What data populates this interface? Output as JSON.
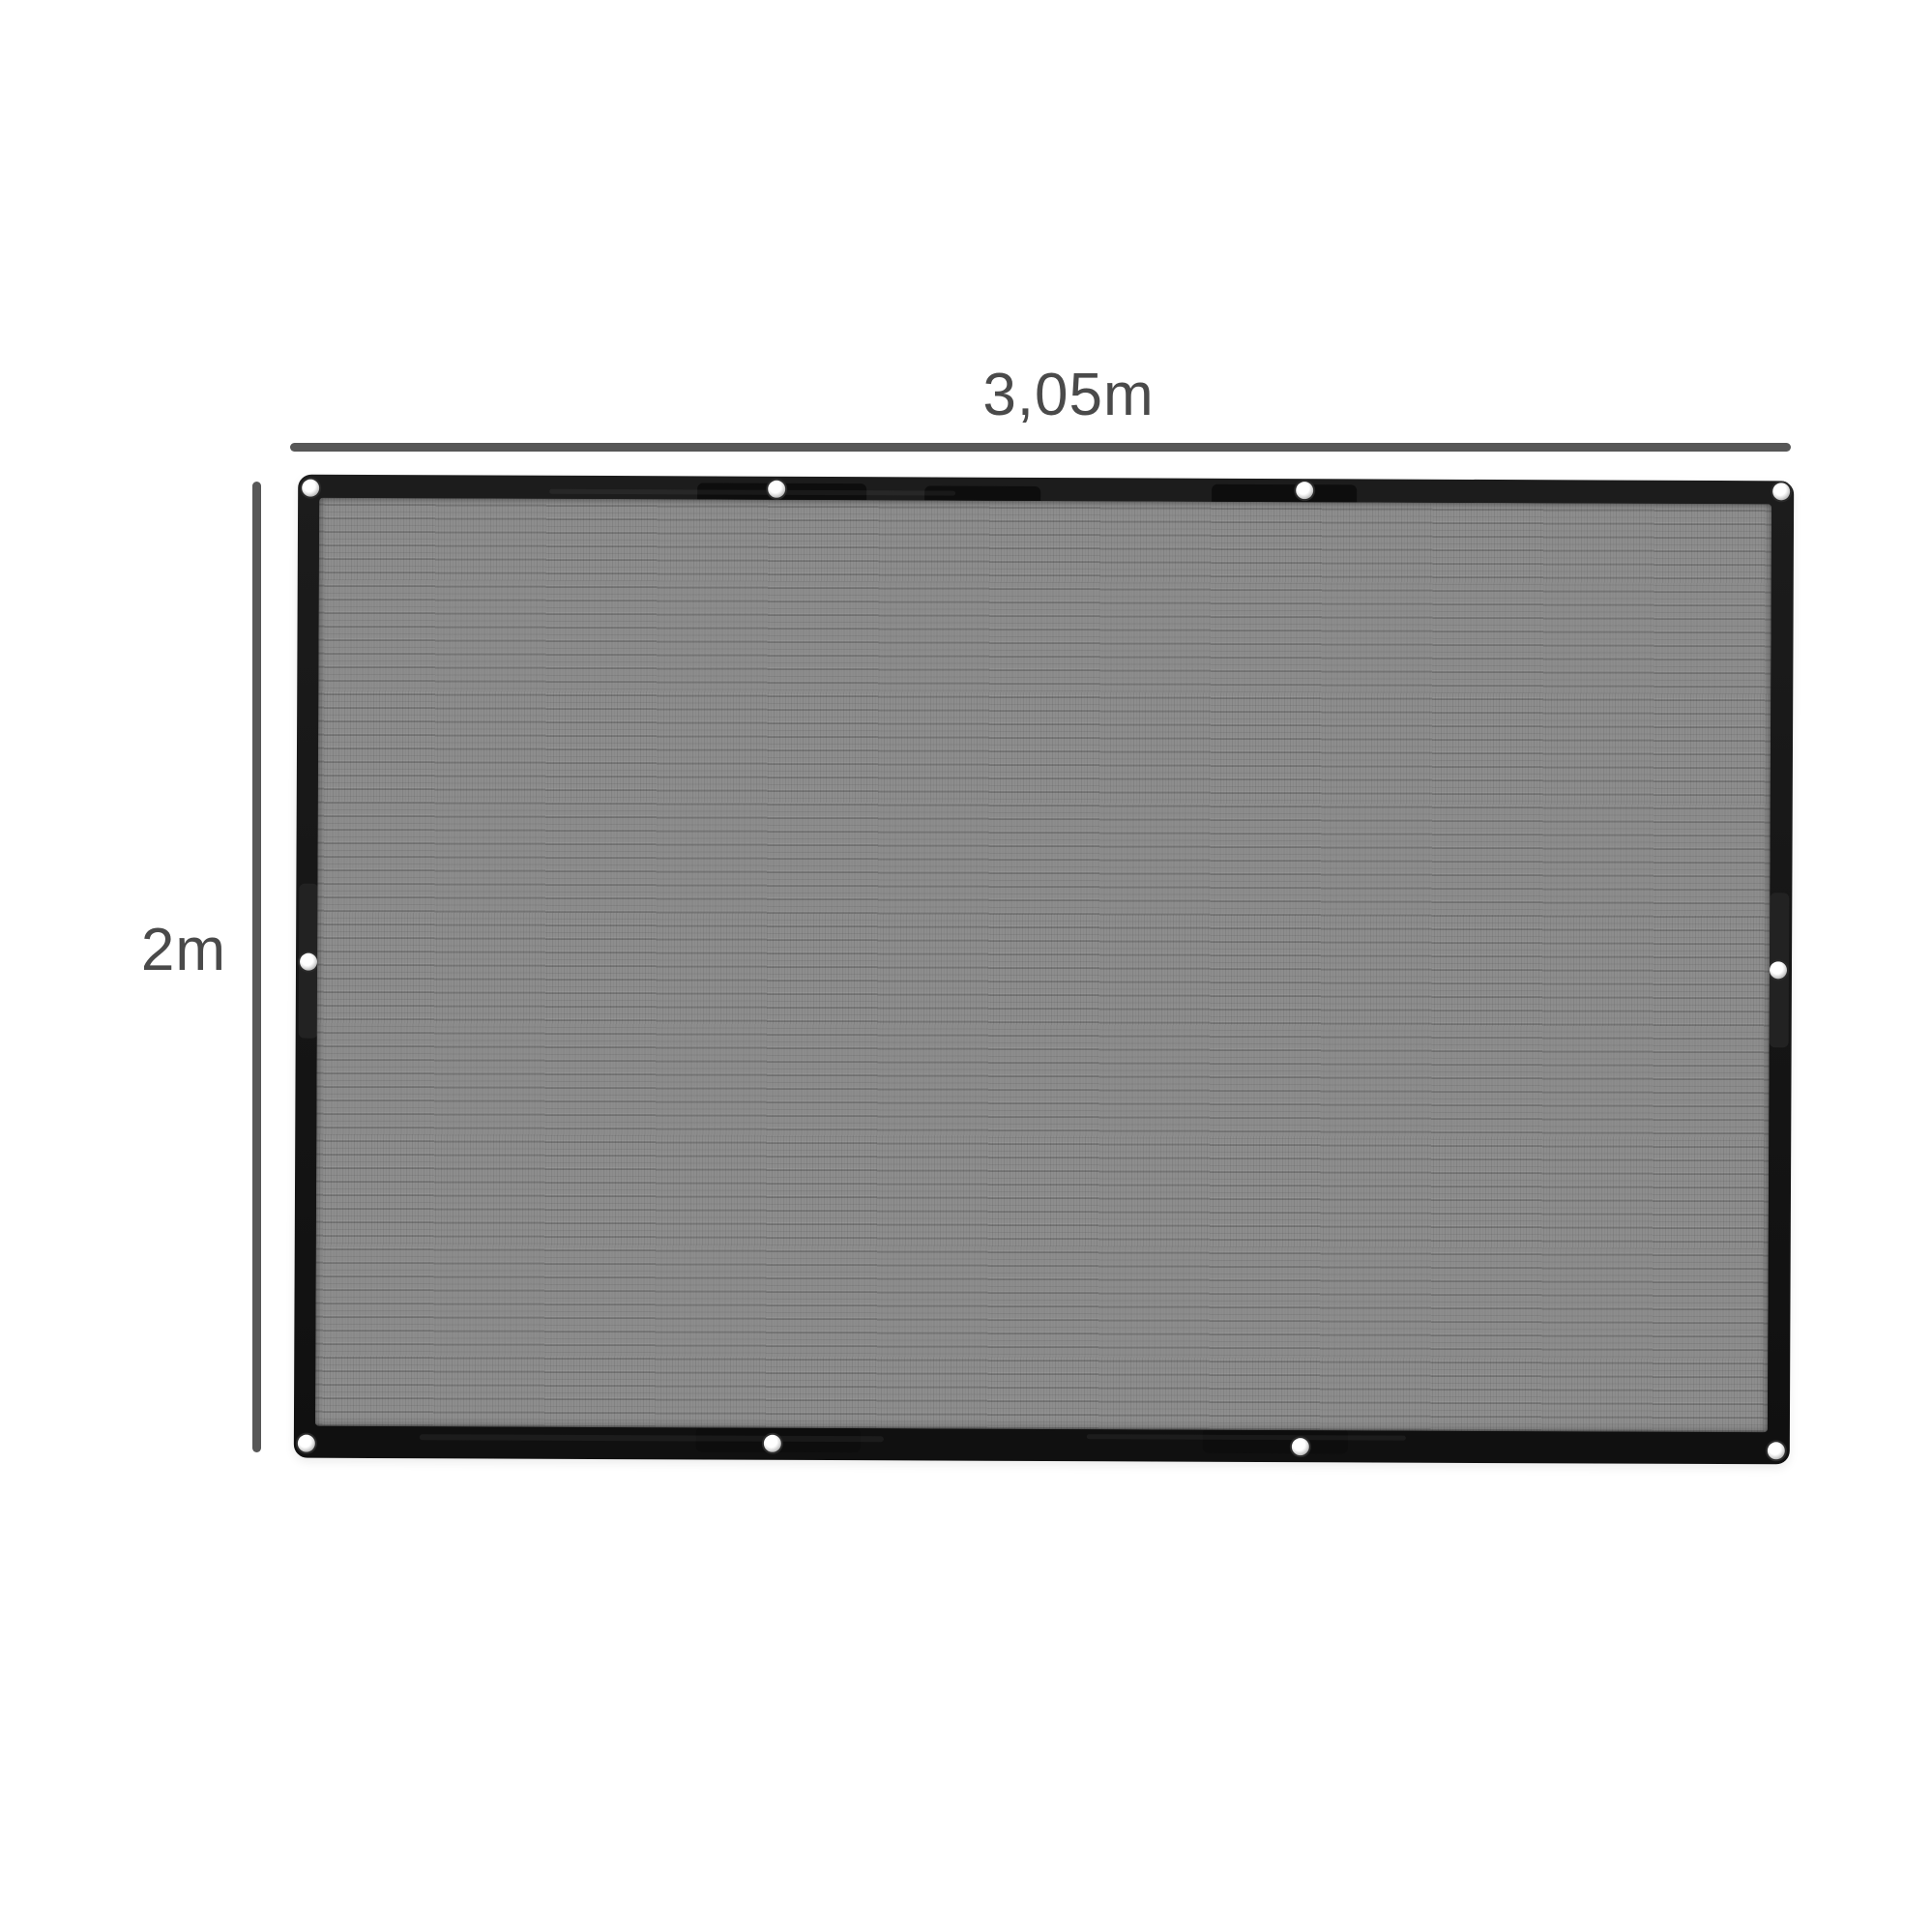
{
  "diagram": {
    "width_label": "3,05m",
    "height_label": "2m"
  },
  "product": {
    "grommet_count": 10
  },
  "colors": {
    "background": "#ffffff",
    "frame": "#181818",
    "mesh": "#8d8d8d",
    "dimension_line": "#575757",
    "label_text": "#4a4a4a",
    "grommet": "#f4f4f4"
  }
}
